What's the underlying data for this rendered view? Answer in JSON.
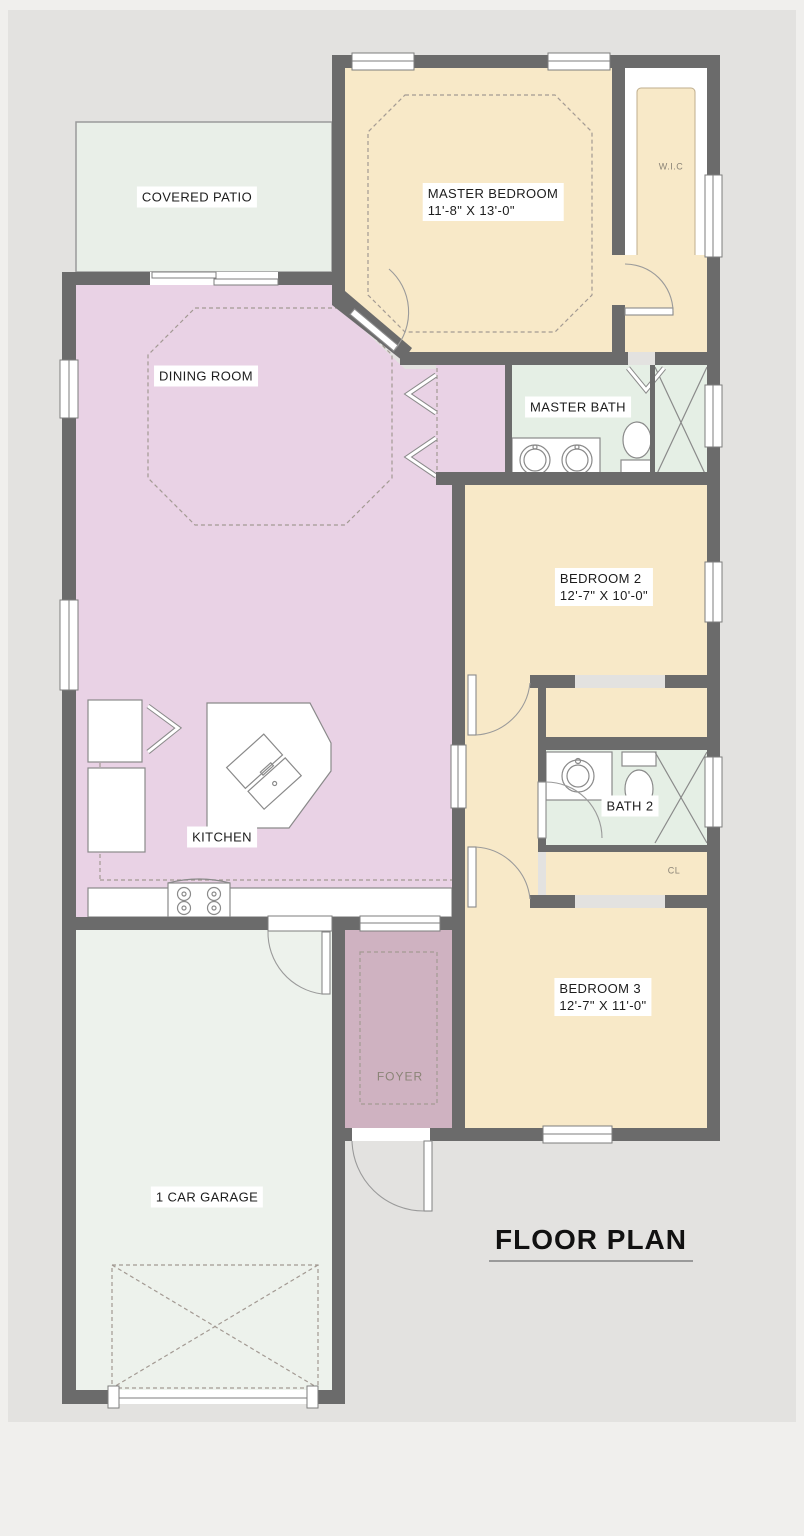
{
  "title": "FLOOR PLAN",
  "rooms": {
    "covered_patio": {
      "name": "COVERED PATIO"
    },
    "master_bedroom": {
      "name": "MASTER BEDROOM",
      "dims": "11'-8\" X 13'-0\""
    },
    "wic": {
      "name": "W.I.C"
    },
    "dining_room": {
      "name": "DINING ROOM"
    },
    "master_bath": {
      "name": "MASTER BATH"
    },
    "bedroom_2": {
      "name": "BEDROOM 2",
      "dims": "12'-7\" X 10'-0\""
    },
    "kitchen": {
      "name": "KITCHEN"
    },
    "bath_2": {
      "name": "BATH 2"
    },
    "closet": {
      "name": "CL"
    },
    "bedroom_3": {
      "name": "BEDROOM 3",
      "dims": "12'-7\" X 11'-0\""
    },
    "foyer": {
      "name": "FOYER"
    },
    "garage": {
      "name": "1 CAR GARAGE"
    }
  },
  "colors": {
    "wall": "#6b6b6b",
    "cream": "#f8e9c8",
    "pink": "#e9d2e5",
    "foyer": "#cfb2c1",
    "patio": "#e9efe8",
    "garage": "#edf2ec",
    "bath": "#e5efe5",
    "bg": "#e3e2e0"
  }
}
